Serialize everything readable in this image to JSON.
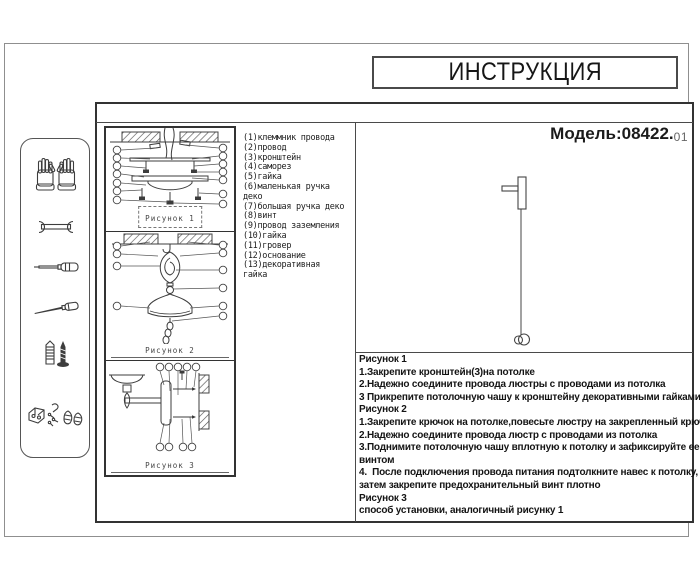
{
  "title": "ИНСТРУКЦИЯ",
  "model": {
    "label": "Модель:",
    "number": "08422.",
    "variant": "01"
  },
  "sidebar": {
    "tools": [
      "gloves",
      "wrench",
      "screwdriver",
      "awl",
      "anchor-and-screw",
      "fasteners-set"
    ]
  },
  "figures": [
    {
      "label": "Рисунок 1"
    },
    {
      "label": "Рисунок 2"
    },
    {
      "label": "Рисунок 3"
    }
  ],
  "parts_list": {
    "lines": [
      "(1)клеммник провода",
      "(2)провод",
      "(3)кронштейн",
      "(4)саморез",
      "(5)гайка",
      "(6)маленькая ручка",
      "деко",
      "(7)большая ручка деко",
      "(8)винт",
      "(9)провод заземления",
      "(10)гайка",
      "(11)гровер",
      "(12)основание",
      "(13)декоративная",
      "гайка"
    ]
  },
  "instructions": {
    "lines": [
      "Рисунок 1",
      "1.Закрепите кронштейн(3)на потолке",
      "2.Надежно соедините провода люстры с проводами из потолка",
      "3 Прикрепите потолочную чашу к кронштейну декоративными гайками",
      "Рисунок 2",
      "1.Закрепите крючок на потолке,повесьте люстру на закрепленный крючок",
      "2.Надежно соедините провода люстр с проводами из потолка",
      "3.Поднимите потолочную чашу вплотную к потолку и зафиксируйте ее",
      "винтом",
      "4.  После подключения провода питания подтолкните навес к потолку,",
      "затем закрепите предохранительный винт плотно",
      "Рисунок 3",
      "способ установки, аналогичный рисунку 1"
    ]
  },
  "colors": {
    "line_dark": "#333333",
    "line_mid": "#4a4a4a",
    "frame_gray": "#8f8f8f",
    "text": "#1a1a1a"
  }
}
